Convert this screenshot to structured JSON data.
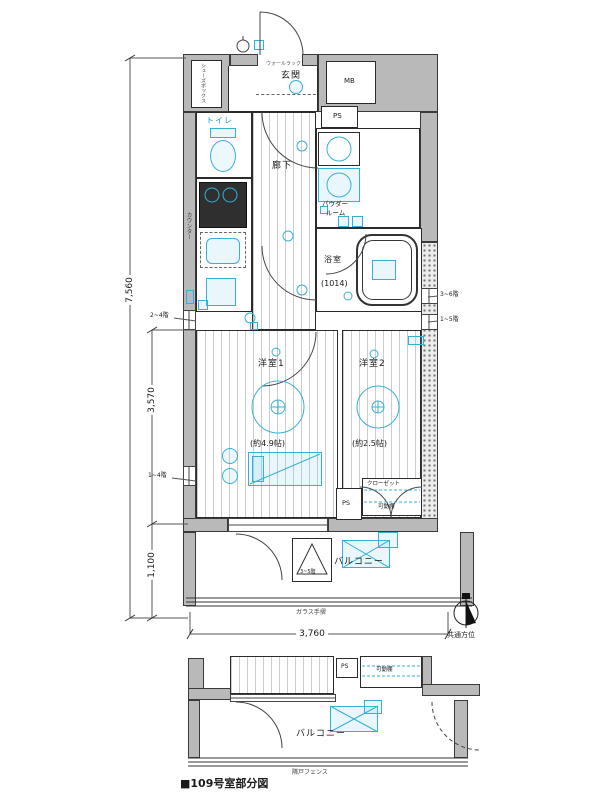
{
  "caption": "■109号室部分図",
  "colors": {
    "accent_cyan": "#35b0d9",
    "wall_gray": "#b9b9b9",
    "line_black": "#2b2b2b"
  },
  "dimensions": {
    "total_depth": "7,560",
    "living_depth": "3,570",
    "balcony_depth": "1,100",
    "width": "3,760"
  },
  "floor_annotations": {
    "left_upper": "2~4階",
    "left_lower": "1~4階",
    "right_upper": "3~6階",
    "right_lower": "1~5階",
    "hatch": "3~5階"
  },
  "plan": {
    "entrance": "玄関",
    "wall_rack": "ウォールラック",
    "shoe_box": "シューズボックス",
    "meter_box": "MB",
    "pipe_space_top": "PS",
    "toilet": "トイレ",
    "hallway": "廊下",
    "counter": "カウンター",
    "powder_line1": "パウダー",
    "powder_line2": "ルーム",
    "bathroom": "浴室",
    "bathroom_size": "(1014)",
    "room1": "洋室1",
    "room1_size": "(約4.9帖)",
    "room2": "洋室2",
    "room2_size": "(約2.5帖)",
    "pipe_space_mid": "PS",
    "closet": "クローゼット",
    "shelf": "可動棚",
    "balcony": "バルコニー",
    "glass_rail": "ガラス手摺"
  },
  "compass_label": "共通方位",
  "partial": {
    "pipe_space": "PS",
    "shelf": "可動棚",
    "balcony": "バルコニー",
    "fence": "隣戸フェンス"
  }
}
